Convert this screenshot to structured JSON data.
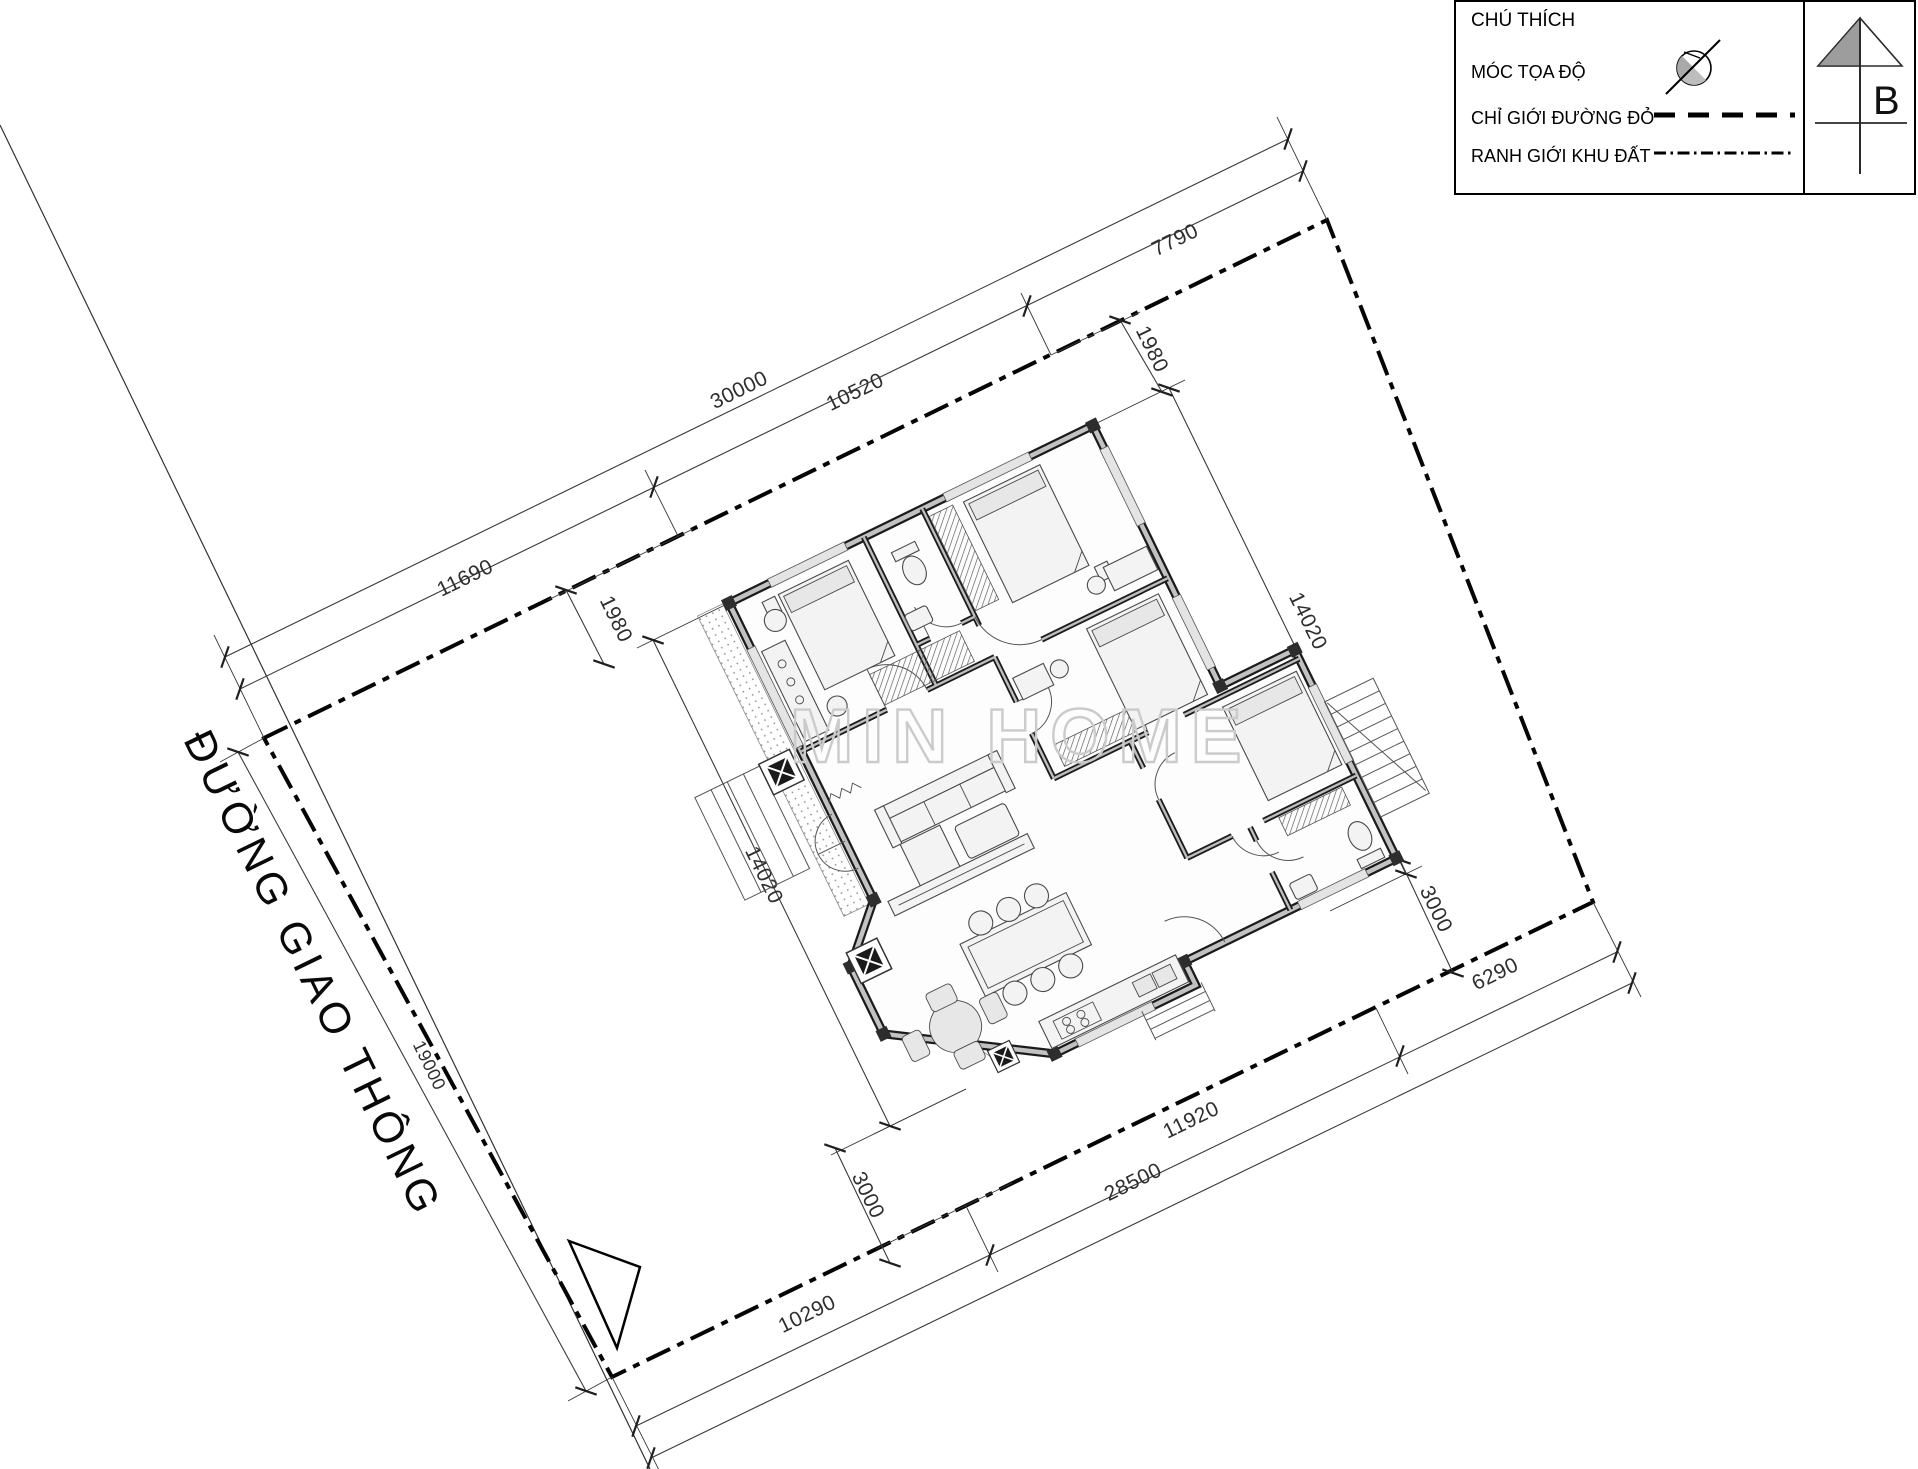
{
  "legend": {
    "title": "CHÚ THÍCH",
    "items": [
      {
        "label": "MÓC TỌA ĐỘ",
        "symbol": "survey-marker-icon"
      },
      {
        "label": "CHỈ GIỚI ĐƯỜNG ĐỎ",
        "symbol": "dashed-line-icon"
      },
      {
        "label": "RANH GIỚI KHU ĐẤT",
        "symbol": "dash-dot-line-icon"
      }
    ]
  },
  "north": {
    "label": "B"
  },
  "road": {
    "name": "ĐƯỜNG GIAO THÔNG"
  },
  "watermark": {
    "text": "MIN HOME"
  },
  "dimensions": {
    "top_overall": "30000",
    "top_seg_left": "11690",
    "top_seg_mid": "10520",
    "top_seg_right": "7790",
    "setback_top_left": "1980",
    "setback_top_right": "1980",
    "house_side_left": "14020",
    "house_side_right": "14020",
    "road_frontage": "19000",
    "bottom_overall": "28500",
    "bottom_seg_left": "10290",
    "bottom_seg_mid": "11920",
    "bottom_seg_right": "6290",
    "setback_bottom_left": "3000",
    "setback_bottom_right": "3000"
  }
}
